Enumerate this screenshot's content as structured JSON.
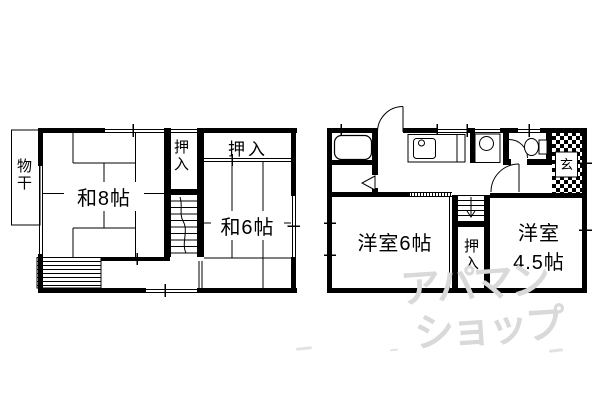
{
  "colors": {
    "line": "#000000",
    "background": "#ffffff",
    "watermark": "#d9d9d9"
  },
  "left_plan": {
    "monohoshi_label": "物干",
    "washitsu8_label": "和8帖",
    "washitsu6_label": "和6帖",
    "oshiire_vertical_label": "押入",
    "oshiire_top_label": "押入"
  },
  "right_plan": {
    "yoshitsu6_label": "洋室6帖",
    "yoshitsu45_label_line1": "洋室",
    "yoshitsu45_label_line2": "4.5帖",
    "oshiire_label": "押入",
    "genkan_label": "玄"
  },
  "watermark": {
    "line1": "アパマン",
    "line2": "ショップ"
  }
}
